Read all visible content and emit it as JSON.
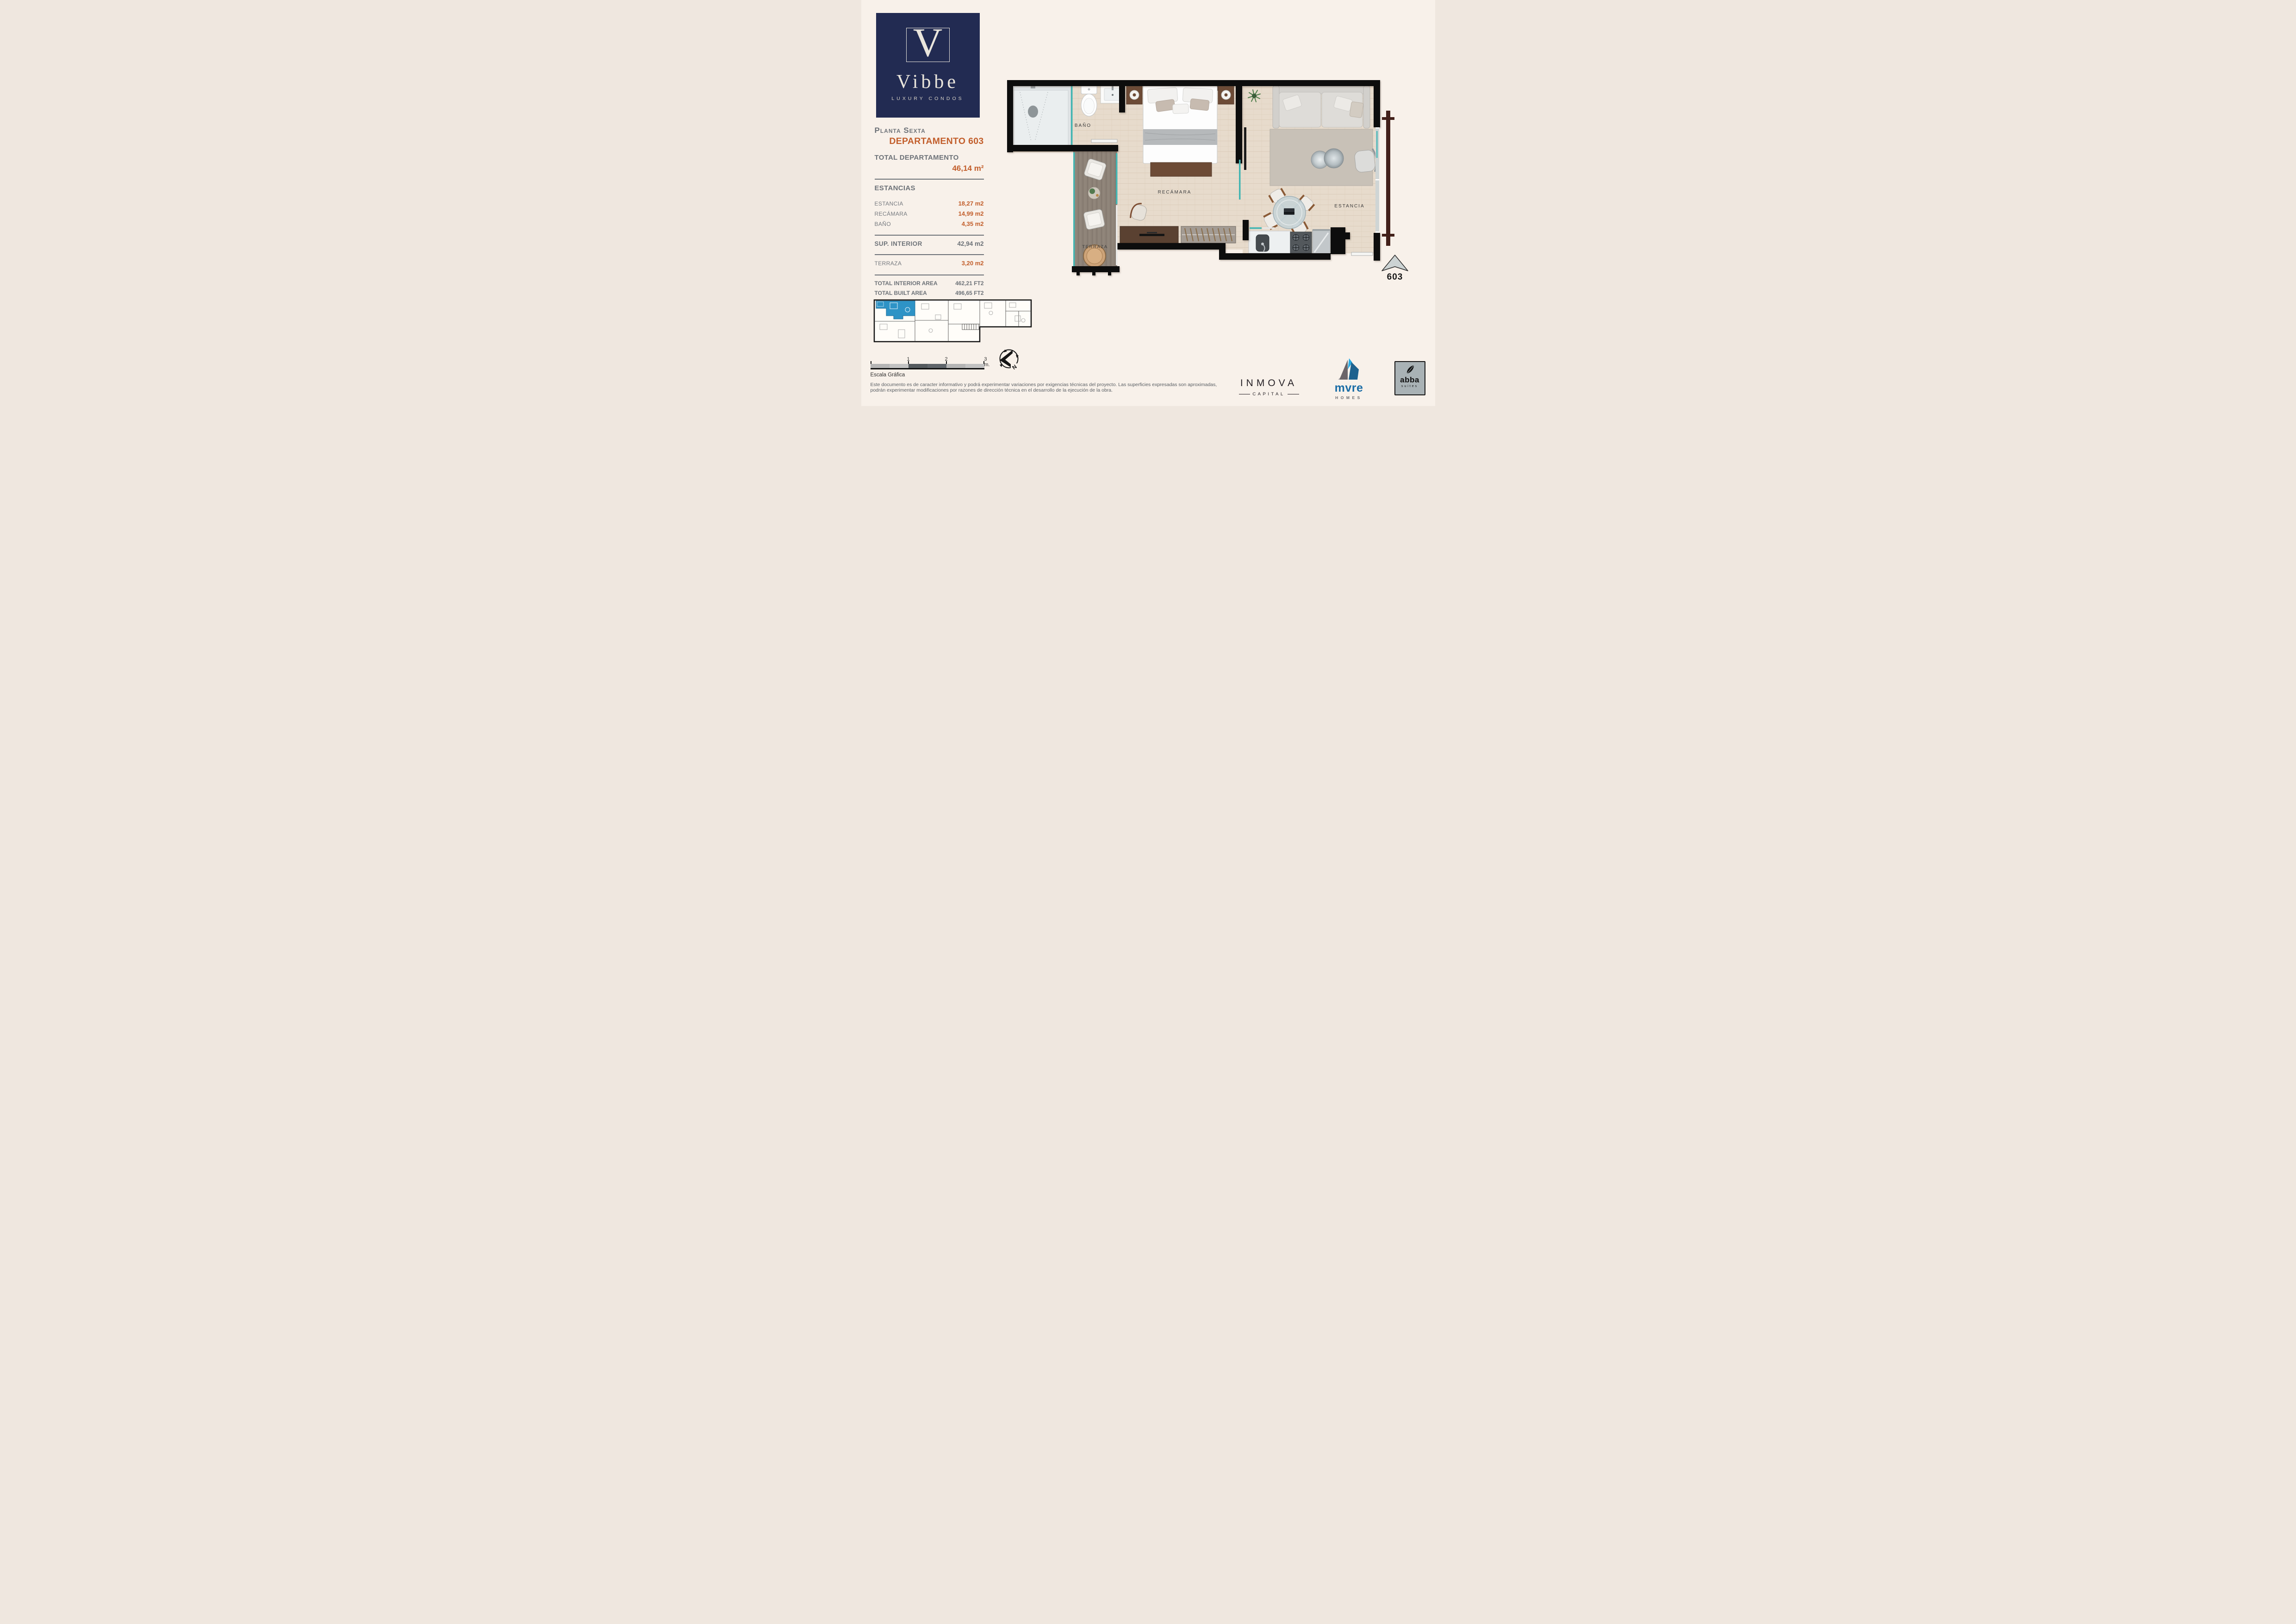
{
  "brand": {
    "initial": "V",
    "name": "Vibbe",
    "tagline": "LUXURY CONDOS"
  },
  "panel": {
    "floor": "Planta Sexta",
    "unit": "DEPARTAMENTO 603",
    "total_label": "TOTAL DEPARTAMENTO",
    "total_value": "46,14 m²",
    "sections_header": "ESTANCIAS",
    "rooms": [
      {
        "label": "ESTANCIA",
        "value": "18,27 m2"
      },
      {
        "label": "RECÁMARA",
        "value": "14,99 m2"
      },
      {
        "label": "BAÑO",
        "value": "4,35 m2"
      }
    ],
    "sup_interior": {
      "label": "SUP. INTERIOR",
      "value": "42,94 m2"
    },
    "terraza": {
      "label": "TERRAZA",
      "value": "3,20 m2"
    },
    "totals": [
      {
        "label": "TOTAL INTERIOR AREA",
        "value": "462,21 FT2"
      },
      {
        "label": "TOTAL BUILT AREA",
        "value": "496,65 FT2"
      }
    ]
  },
  "plan": {
    "rooms": {
      "bano": "BAÑO",
      "recamara": "RECÁMARA",
      "estancia": "ESTANCIA",
      "terraza": "TERRAZA"
    },
    "unit_number": "603"
  },
  "scale_bar": {
    "ticks": [
      "1",
      "2",
      "3 m."
    ],
    "caption": "Escala Gráfica"
  },
  "compass": {
    "north": "N"
  },
  "disclaimer": {
    "line1": "Este documento es de caracter informativo y podrá experimentar variaciones por exigencias técnicas del proyecto. Las superficies expresadas son aproximadas,",
    "line2": "podrán experimentar modificaciones por razones de dirección técnica en el desarrollo de la ejecución de la obra."
  },
  "partners": {
    "inmova": {
      "name": "INMOVA",
      "sub": "CAPITAL"
    },
    "mvre": {
      "name": "mvre",
      "sub": "HOMES"
    },
    "abba": {
      "name": "abba",
      "sub": "suites"
    }
  },
  "colors": {
    "accent_orange": "#c25e2b",
    "text_gray": "#6d7278",
    "brand_navy": "#222b52",
    "highlight_blue": "#2e93c6",
    "glass_teal": "#43b5b2",
    "wall_black": "#0c0c0c",
    "floor_beige": "#e7dbcc",
    "deck_wood": "#8e8378",
    "railing_maroon": "#42201a",
    "page_cream": "#f8f1ea",
    "mvre_blue": "#1b6da6",
    "mvre_cyan": "#29a9e1"
  }
}
